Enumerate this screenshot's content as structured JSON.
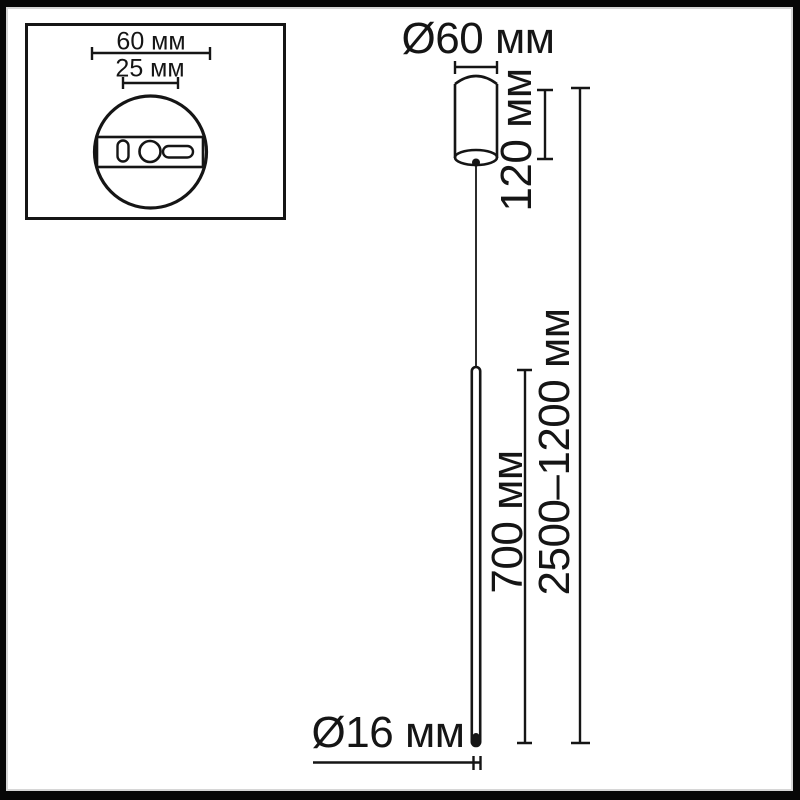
{
  "title": "pendant-lamp-dimension-diagram",
  "colors": {
    "line": "#151515",
    "background": "#ffffff",
    "frame": "#070707"
  },
  "inset": {
    "plate_diameter_label": "60 мм",
    "mount_spacing_label": "25 мм"
  },
  "dimensions": {
    "canopy_diameter": "Ø60 мм",
    "canopy_height": "120 мм",
    "tube_length": "700 мм",
    "overall_height": "2500–1200 мм",
    "tube_diameter": "Ø16 мм"
  }
}
